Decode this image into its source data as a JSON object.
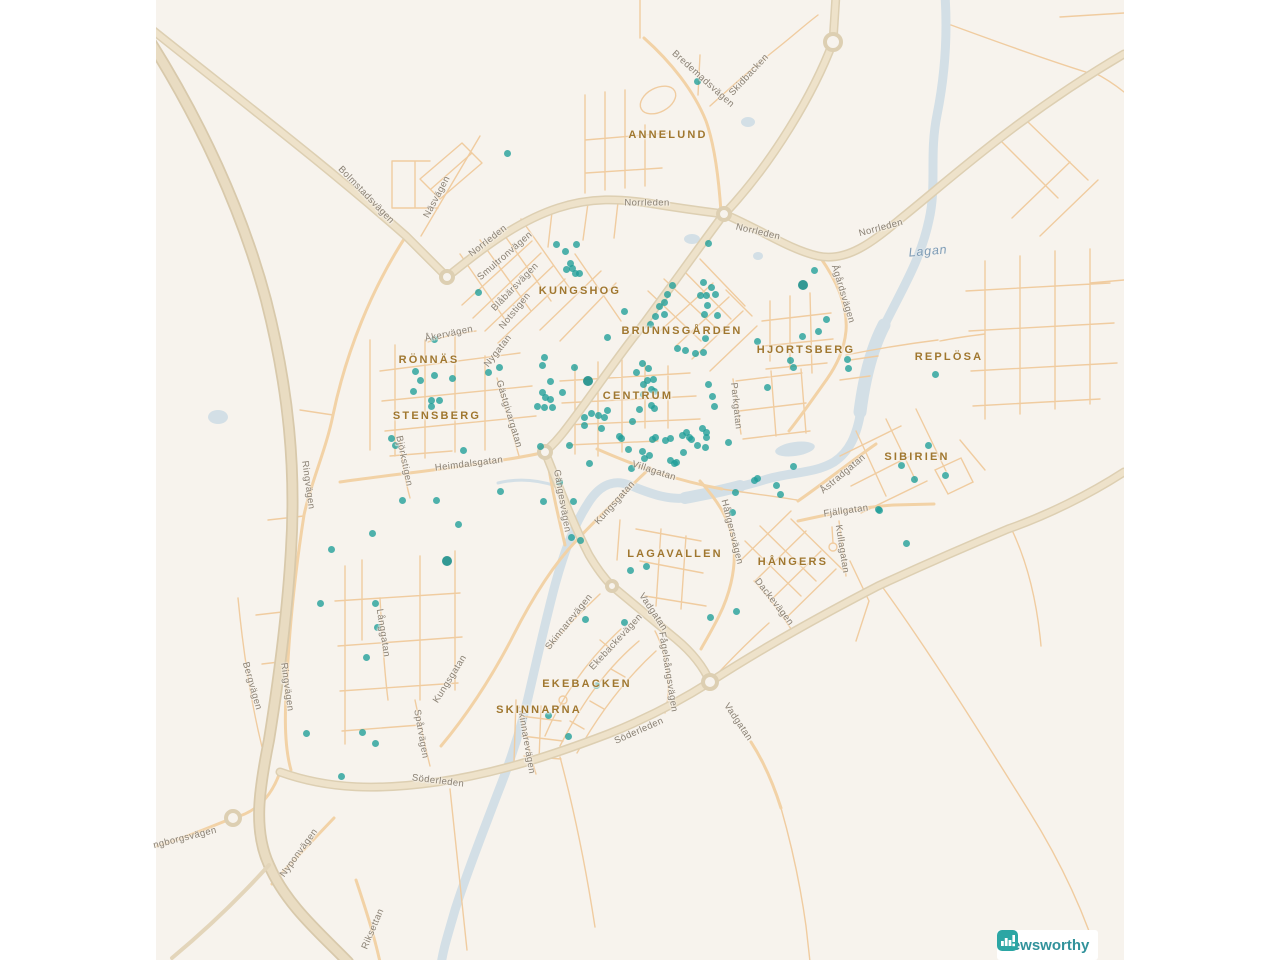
{
  "page": {
    "width": 1280,
    "height": 960,
    "background": "#ffffff"
  },
  "map": {
    "land_color": "#f7f3ed",
    "water_color": "#d3dfe6",
    "dot_color": "#1f9e98",
    "area_label_color": "#a0772f",
    "street_label_color": "#8a8174",
    "bounds": {
      "left": 156,
      "top": 0,
      "width": 968,
      "height": 960
    },
    "area_labels": [
      {
        "text": "ANNELUND",
        "x": 668,
        "y": 135
      },
      {
        "text": "KUNGSHOG",
        "x": 580,
        "y": 291
      },
      {
        "text": "BRUNNSGÅRDEN",
        "x": 682,
        "y": 331
      },
      {
        "text": "HJORTSBERG",
        "x": 806,
        "y": 350
      },
      {
        "text": "REPLÖSA",
        "x": 949,
        "y": 357
      },
      {
        "text": "RÖNNÄS",
        "x": 429,
        "y": 360
      },
      {
        "text": "CENTRUM",
        "x": 638,
        "y": 396
      },
      {
        "text": "STENSBERG",
        "x": 437,
        "y": 416
      },
      {
        "text": "SIBIRIEN",
        "x": 917,
        "y": 457
      },
      {
        "text": "LAGAVALLEN",
        "x": 675,
        "y": 554
      },
      {
        "text": "HÅNGERS",
        "x": 793,
        "y": 562
      },
      {
        "text": "EKEBACKEN",
        "x": 587,
        "y": 684
      },
      {
        "text": "SKINNARNA",
        "x": 539,
        "y": 710
      }
    ],
    "street_labels": [
      {
        "text": "Bredemadsvägen",
        "x": 703,
        "y": 79,
        "rot": 42
      },
      {
        "text": "Skidbacken",
        "x": 749,
        "y": 75,
        "rot": -47
      },
      {
        "text": "Norrleden",
        "x": 647,
        "y": 203,
        "rot": 0
      },
      {
        "text": "Norrleden",
        "x": 758,
        "y": 232,
        "rot": 13
      },
      {
        "text": "Norrleden",
        "x": 881,
        "y": 228,
        "rot": -15
      },
      {
        "text": "Norrleden",
        "x": 488,
        "y": 241,
        "rot": -38
      },
      {
        "text": "Bolmstadsvägen",
        "x": 366,
        "y": 195,
        "rot": 46
      },
      {
        "text": "Näsvägen",
        "x": 437,
        "y": 197,
        "rot": -62
      },
      {
        "text": "Smultronvägen",
        "x": 505,
        "y": 256,
        "rot": -41
      },
      {
        "text": "Blåbärsvägen",
        "x": 515,
        "y": 287,
        "rot": -46
      },
      {
        "text": "Notstigen",
        "x": 515,
        "y": 311,
        "rot": -51
      },
      {
        "text": "Åkervägen",
        "x": 449,
        "y": 334,
        "rot": -12
      },
      {
        "text": "Nygatan",
        "x": 498,
        "y": 351,
        "rot": -52
      },
      {
        "text": "Gästgivargatan",
        "x": 509,
        "y": 414,
        "rot": 73
      },
      {
        "text": "Heimdalsgatan",
        "x": 469,
        "y": 464,
        "rot": -7
      },
      {
        "text": "Björkstigen",
        "x": 404,
        "y": 461,
        "rot": 78
      },
      {
        "text": "Villagatan",
        "x": 654,
        "y": 471,
        "rot": 18
      },
      {
        "text": "Kungsgatan",
        "x": 615,
        "y": 503,
        "rot": -48
      },
      {
        "text": "Gängesvägen",
        "x": 562,
        "y": 501,
        "rot": 80
      },
      {
        "text": "Parkgatan",
        "x": 736,
        "y": 406,
        "rot": 84
      },
      {
        "text": "Ågårdsvägen",
        "x": 843,
        "y": 294,
        "rot": 73
      },
      {
        "text": "Åstradgatan",
        "x": 843,
        "y": 474,
        "rot": -40
      },
      {
        "text": "Fjällgatan",
        "x": 846,
        "y": 511,
        "rot": -8
      },
      {
        "text": "Hångersvägen",
        "x": 732,
        "y": 532,
        "rot": 76
      },
      {
        "text": "Kullagatan",
        "x": 842,
        "y": 549,
        "rot": 81
      },
      {
        "text": "Dackevägen",
        "x": 774,
        "y": 602,
        "rot": 52
      },
      {
        "text": "Vadgatan",
        "x": 653,
        "y": 612,
        "rot": 56
      },
      {
        "text": "Vadgatan",
        "x": 738,
        "y": 722,
        "rot": 56
      },
      {
        "text": "Skinnarevägen",
        "x": 569,
        "y": 622,
        "rot": -51
      },
      {
        "text": "Ekebackevägen",
        "x": 616,
        "y": 642,
        "rot": -47
      },
      {
        "text": "Fågelsångsvägen",
        "x": 668,
        "y": 672,
        "rot": 81
      },
      {
        "text": "Söderleden",
        "x": 639,
        "y": 731,
        "rot": -24
      },
      {
        "text": "Söderleden",
        "x": 438,
        "y": 781,
        "rot": 7
      },
      {
        "text": "Skinnarevägen",
        "x": 526,
        "y": 740,
        "rot": 80
      },
      {
        "text": "Långgatan",
        "x": 383,
        "y": 633,
        "rot": 81
      },
      {
        "text": "Kungsgatan",
        "x": 450,
        "y": 679,
        "rot": -58
      },
      {
        "text": "Spårvägen",
        "x": 421,
        "y": 734,
        "rot": 80
      },
      {
        "text": "Ringvägen",
        "x": 308,
        "y": 485,
        "rot": 82
      },
      {
        "text": "Ringvägen",
        "x": 287,
        "y": 687,
        "rot": 82
      },
      {
        "text": "Bergvägen",
        "x": 252,
        "y": 686,
        "rot": 74
      },
      {
        "text": "ngborgsvägen",
        "x": 185,
        "y": 838,
        "rot": -14
      },
      {
        "text": "Nyponvägen",
        "x": 299,
        "y": 853,
        "rot": -54
      },
      {
        "text": "Riksettan",
        "x": 373,
        "y": 929,
        "rot": -67
      }
    ],
    "water_labels": [
      {
        "text": "Lagan",
        "x": 928,
        "y": 251,
        "rot": -5
      }
    ],
    "dots": [
      [
        697,
        81
      ],
      [
        507,
        153
      ],
      [
        556,
        244
      ],
      [
        565,
        251
      ],
      [
        576,
        244
      ],
      [
        570,
        263
      ],
      [
        572,
        268
      ],
      [
        566,
        269
      ],
      [
        575,
        273
      ],
      [
        579,
        273
      ],
      [
        478,
        292
      ],
      [
        708,
        243
      ],
      [
        814,
        270
      ],
      [
        803,
        285,
        1
      ],
      [
        703,
        282
      ],
      [
        711,
        287
      ],
      [
        700,
        295
      ],
      [
        706,
        295
      ],
      [
        715,
        294
      ],
      [
        707,
        305
      ],
      [
        704,
        314
      ],
      [
        717,
        315
      ],
      [
        672,
        285
      ],
      [
        667,
        294
      ],
      [
        664,
        302
      ],
      [
        659,
        306
      ],
      [
        664,
        314
      ],
      [
        655,
        316
      ],
      [
        650,
        324
      ],
      [
        624,
        311
      ],
      [
        607,
        337
      ],
      [
        677,
        348
      ],
      [
        685,
        350
      ],
      [
        695,
        353
      ],
      [
        703,
        352
      ],
      [
        705,
        338
      ],
      [
        757,
        341
      ],
      [
        826,
        319
      ],
      [
        818,
        331
      ],
      [
        802,
        336
      ],
      [
        790,
        360
      ],
      [
        793,
        367
      ],
      [
        847,
        359
      ],
      [
        848,
        368
      ],
      [
        935,
        374
      ],
      [
        434,
        339
      ],
      [
        415,
        371
      ],
      [
        420,
        380
      ],
      [
        434,
        375
      ],
      [
        452,
        378
      ],
      [
        413,
        391
      ],
      [
        431,
        400
      ],
      [
        439,
        400
      ],
      [
        431,
        406
      ],
      [
        488,
        372
      ],
      [
        499,
        367
      ],
      [
        544,
        357
      ],
      [
        542,
        365
      ],
      [
        550,
        381
      ],
      [
        574,
        367
      ],
      [
        588,
        381,
        1
      ],
      [
        542,
        392
      ],
      [
        545,
        397
      ],
      [
        550,
        399
      ],
      [
        562,
        392
      ],
      [
        537,
        406
      ],
      [
        544,
        407
      ],
      [
        552,
        407
      ],
      [
        584,
        417
      ],
      [
        591,
        413
      ],
      [
        598,
        415
      ],
      [
        607,
        410
      ],
      [
        584,
        425
      ],
      [
        642,
        363
      ],
      [
        648,
        368
      ],
      [
        636,
        372
      ],
      [
        653,
        379
      ],
      [
        647,
        380
      ],
      [
        643,
        384
      ],
      [
        651,
        389
      ],
      [
        654,
        391
      ],
      [
        643,
        394
      ],
      [
        651,
        405
      ],
      [
        654,
        408
      ],
      [
        639,
        409
      ],
      [
        604,
        417
      ],
      [
        632,
        421
      ],
      [
        601,
        428
      ],
      [
        619,
        436
      ],
      [
        621,
        438
      ],
      [
        628,
        449
      ],
      [
        642,
        451
      ],
      [
        652,
        439
      ],
      [
        655,
        437
      ],
      [
        665,
        440
      ],
      [
        670,
        438
      ],
      [
        674,
        463
      ],
      [
        682,
        435
      ],
      [
        686,
        432
      ],
      [
        683,
        452
      ],
      [
        689,
        437
      ],
      [
        691,
        439
      ],
      [
        697,
        445
      ],
      [
        702,
        428
      ],
      [
        705,
        447
      ],
      [
        706,
        432
      ],
      [
        706,
        437
      ],
      [
        728,
        442
      ],
      [
        708,
        384
      ],
      [
        712,
        396
      ],
      [
        714,
        406
      ],
      [
        767,
        387
      ],
      [
        631,
        468
      ],
      [
        649,
        455
      ],
      [
        670,
        460
      ],
      [
        676,
        462
      ],
      [
        644,
        458
      ],
      [
        928,
        445
      ],
      [
        901,
        465
      ],
      [
        914,
        479
      ],
      [
        945,
        475
      ],
      [
        793,
        466
      ],
      [
        879,
        510
      ],
      [
        754,
        480
      ],
      [
        757,
        478
      ],
      [
        776,
        485
      ],
      [
        780,
        494
      ],
      [
        735,
        492
      ],
      [
        732,
        512
      ],
      [
        878,
        509
      ],
      [
        906,
        543
      ],
      [
        646,
        566
      ],
      [
        630,
        570
      ],
      [
        736,
        611
      ],
      [
        710,
        617
      ],
      [
        559,
        482
      ],
      [
        543,
        501
      ],
      [
        573,
        501
      ],
      [
        589,
        463
      ],
      [
        569,
        445
      ],
      [
        571,
        537
      ],
      [
        580,
        540
      ],
      [
        391,
        438
      ],
      [
        395,
        445
      ],
      [
        463,
        450
      ],
      [
        540,
        446
      ],
      [
        500,
        491
      ],
      [
        436,
        500
      ],
      [
        402,
        500
      ],
      [
        458,
        524
      ],
      [
        372,
        533
      ],
      [
        331,
        549
      ],
      [
        447,
        561,
        1
      ],
      [
        320,
        603
      ],
      [
        375,
        603
      ],
      [
        377,
        627
      ],
      [
        366,
        657
      ],
      [
        306,
        733
      ],
      [
        362,
        732
      ],
      [
        375,
        743
      ],
      [
        341,
        776
      ],
      [
        585,
        619
      ],
      [
        624,
        622
      ],
      [
        596,
        685
      ],
      [
        548,
        715
      ],
      [
        568,
        736
      ]
    ]
  },
  "attribution": {
    "brand": "Newsworthy",
    "icon_color": "#2ca6a4",
    "text_color": "#31929b"
  }
}
